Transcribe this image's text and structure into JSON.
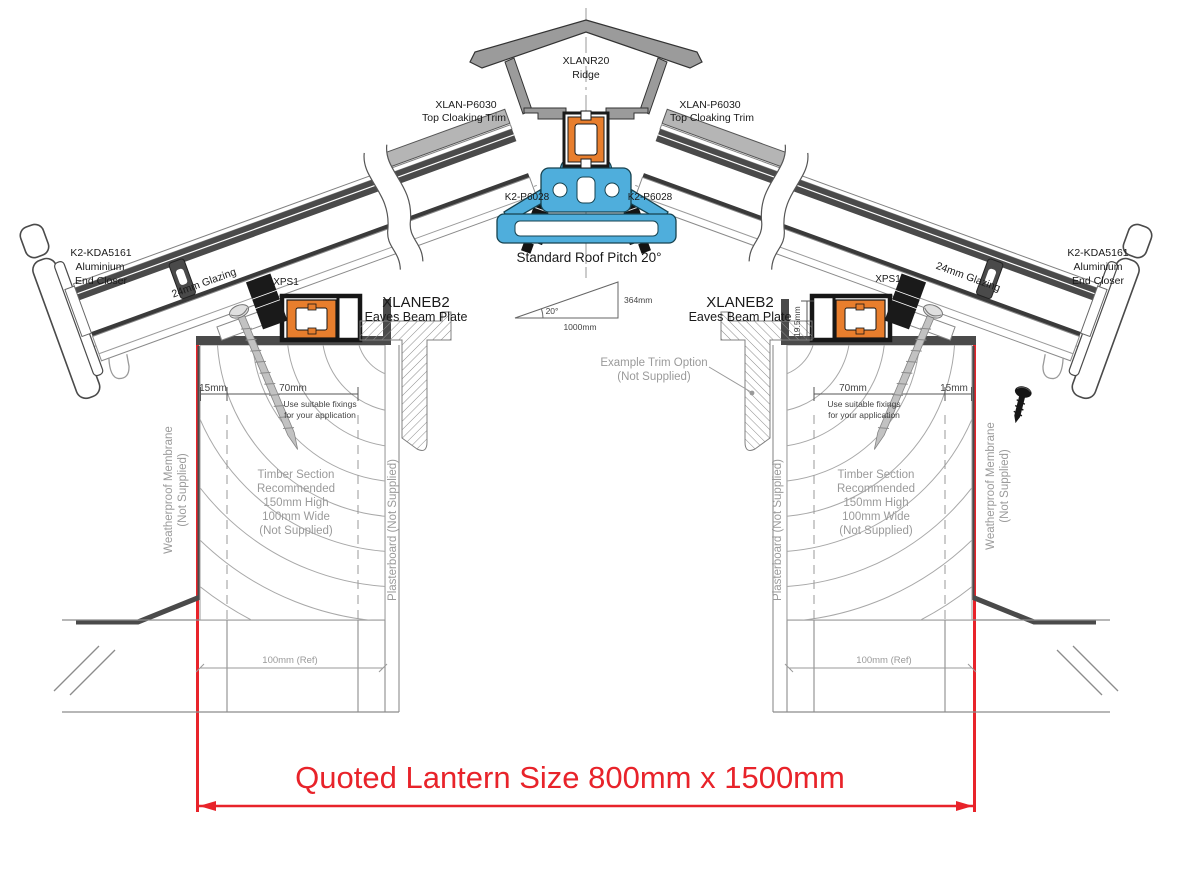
{
  "drawing": {
    "ridge": {
      "code": "XLANR20",
      "name": "Ridge"
    },
    "top_cloaking_trim": {
      "code": "XLAN-P6030",
      "name": "Top Cloaking Trim"
    },
    "ridge_fixing_code": "K2-P6028",
    "pitch_label": "Standard Roof Pitch 20°",
    "pitch_triangle": {
      "angle": "20°",
      "rise": "364mm",
      "run": "1000mm"
    },
    "end_closer": {
      "code": "K2-KDA5161",
      "line2": "Aluminium",
      "line3": "End Closer"
    },
    "glazing_label": "24mm Glazing",
    "spacer_code": "XPS1",
    "eaves_beam": {
      "code": "XLANEB2",
      "name": "Eaves Beam Plate",
      "height_dim": "19.5mm"
    },
    "fixing_note": {
      "line1": "Use suitable fixings",
      "line2": "for your application"
    },
    "dim_15": "15mm",
    "dim_70": "70mm",
    "dim_100_ref": "100mm (Ref)",
    "timber_note": {
      "line1": "Timber Section",
      "line2": "Recommended",
      "line3": "150mm High",
      "line4": "100mm Wide",
      "line5": "(Not Supplied)"
    },
    "membrane_note": {
      "line1": "Weatherproof Membrane",
      "line2": "(Not Supplied)"
    },
    "plasterboard_note": "Plasterboard (Not Supplied)",
    "trim_option_note": {
      "line1": "Example Trim Option",
      "line2": "(Not Supplied)"
    },
    "quoted_size": "Quoted Lantern Size 800mm x 1500mm",
    "colors": {
      "accent_red": "#e8232a",
      "profile_orange": "#e87e2d",
      "profile_blue": "#4faedc"
    }
  }
}
